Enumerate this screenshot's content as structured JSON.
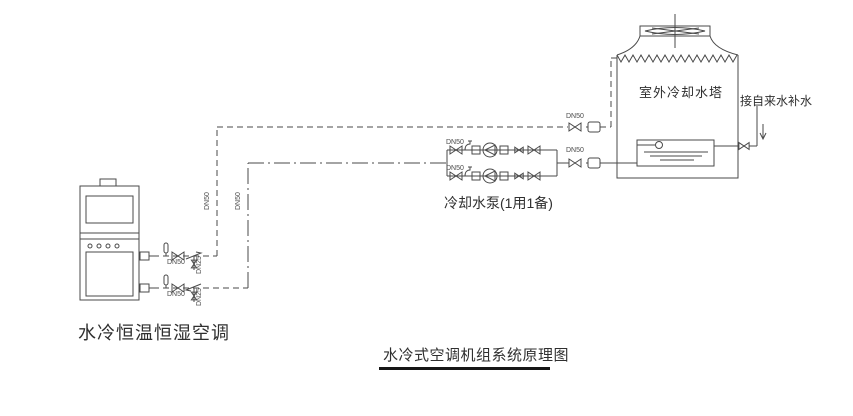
{
  "diagram": {
    "title": "水冷式空调机组系统原理图",
    "ac_unit_label": "水冷恒温恒湿空调",
    "pump_group_label": "冷却水泵(1用1备)",
    "cooling_tower_label": "室外冷却水塔",
    "makeup_water_label": "接自来水补水",
    "pipe_size_main": "DN50",
    "pipe_size_branch": "DN25",
    "colors": {
      "line": "#4a4a4a",
      "text": "#3a3a3a",
      "background": "#ffffff",
      "title_underline": "#161616"
    }
  }
}
